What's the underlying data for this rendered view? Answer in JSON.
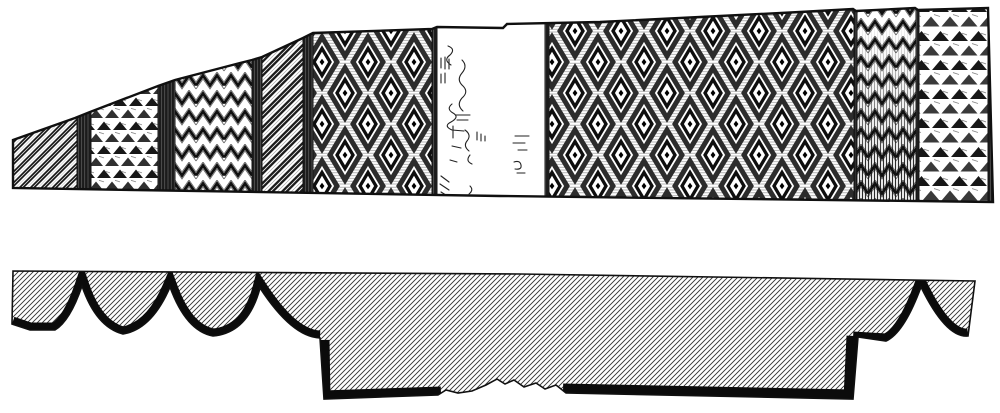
{
  "figure": {
    "kind": "woodcut-engraving-plate",
    "ink_color": "#141414",
    "paper_color": "#ffffff",
    "views": [
      "ornamented-band-elevation",
      "cross-section-profile"
    ]
  },
  "top_band": {
    "segments": [
      {
        "id": "s1",
        "pattern": "diagonal-stripes",
        "x": 10,
        "w": 67
      },
      {
        "id": "s2",
        "pattern": "dark-divider",
        "x": 77,
        "w": 14
      },
      {
        "id": "s3",
        "pattern": "solid-triangles",
        "x": 91,
        "w": 67
      },
      {
        "id": "s4",
        "pattern": "dark-divider",
        "x": 158,
        "w": 17
      },
      {
        "id": "s5",
        "pattern": "zigzag-chevrons",
        "x": 175,
        "w": 77
      },
      {
        "id": "s6",
        "pattern": "dark-divider",
        "x": 252,
        "w": 10
      },
      {
        "id": "s7",
        "pattern": "diagonal-stripes-wide",
        "x": 262,
        "w": 41
      },
      {
        "id": "s8",
        "pattern": "dark-divider",
        "x": 303,
        "w": 10
      },
      {
        "id": "s9",
        "pattern": "diamond-lattice",
        "x": 313,
        "w": 119
      },
      {
        "id": "s10",
        "pattern": "dark-line",
        "x": 432,
        "w": 5
      },
      {
        "id": "s11",
        "pattern": "blank-worn",
        "x": 437,
        "w": 108
      },
      {
        "id": "s12",
        "pattern": "dark-line",
        "x": 545,
        "w": 4
      },
      {
        "id": "s13",
        "pattern": "diamond-lattice",
        "x": 549,
        "w": 305
      },
      {
        "id": "s14",
        "pattern": "dark-line",
        "x": 854,
        "w": 3
      },
      {
        "id": "s15",
        "pattern": "zigzag-shaded",
        "x": 857,
        "w": 59
      },
      {
        "id": "s16",
        "pattern": "dark-line",
        "x": 916,
        "w": 3
      },
      {
        "id": "s17",
        "pattern": "solid-triangles-large",
        "x": 919,
        "w": 69
      },
      {
        "id": "s18",
        "pattern": "dark-line",
        "x": 988,
        "w": 6
      }
    ]
  },
  "bottom_profile": {
    "left_scallop_cusps": 3,
    "right_scallop_cusps": 1,
    "central_tab": true,
    "worn_gap_in_lower_edge": true
  }
}
